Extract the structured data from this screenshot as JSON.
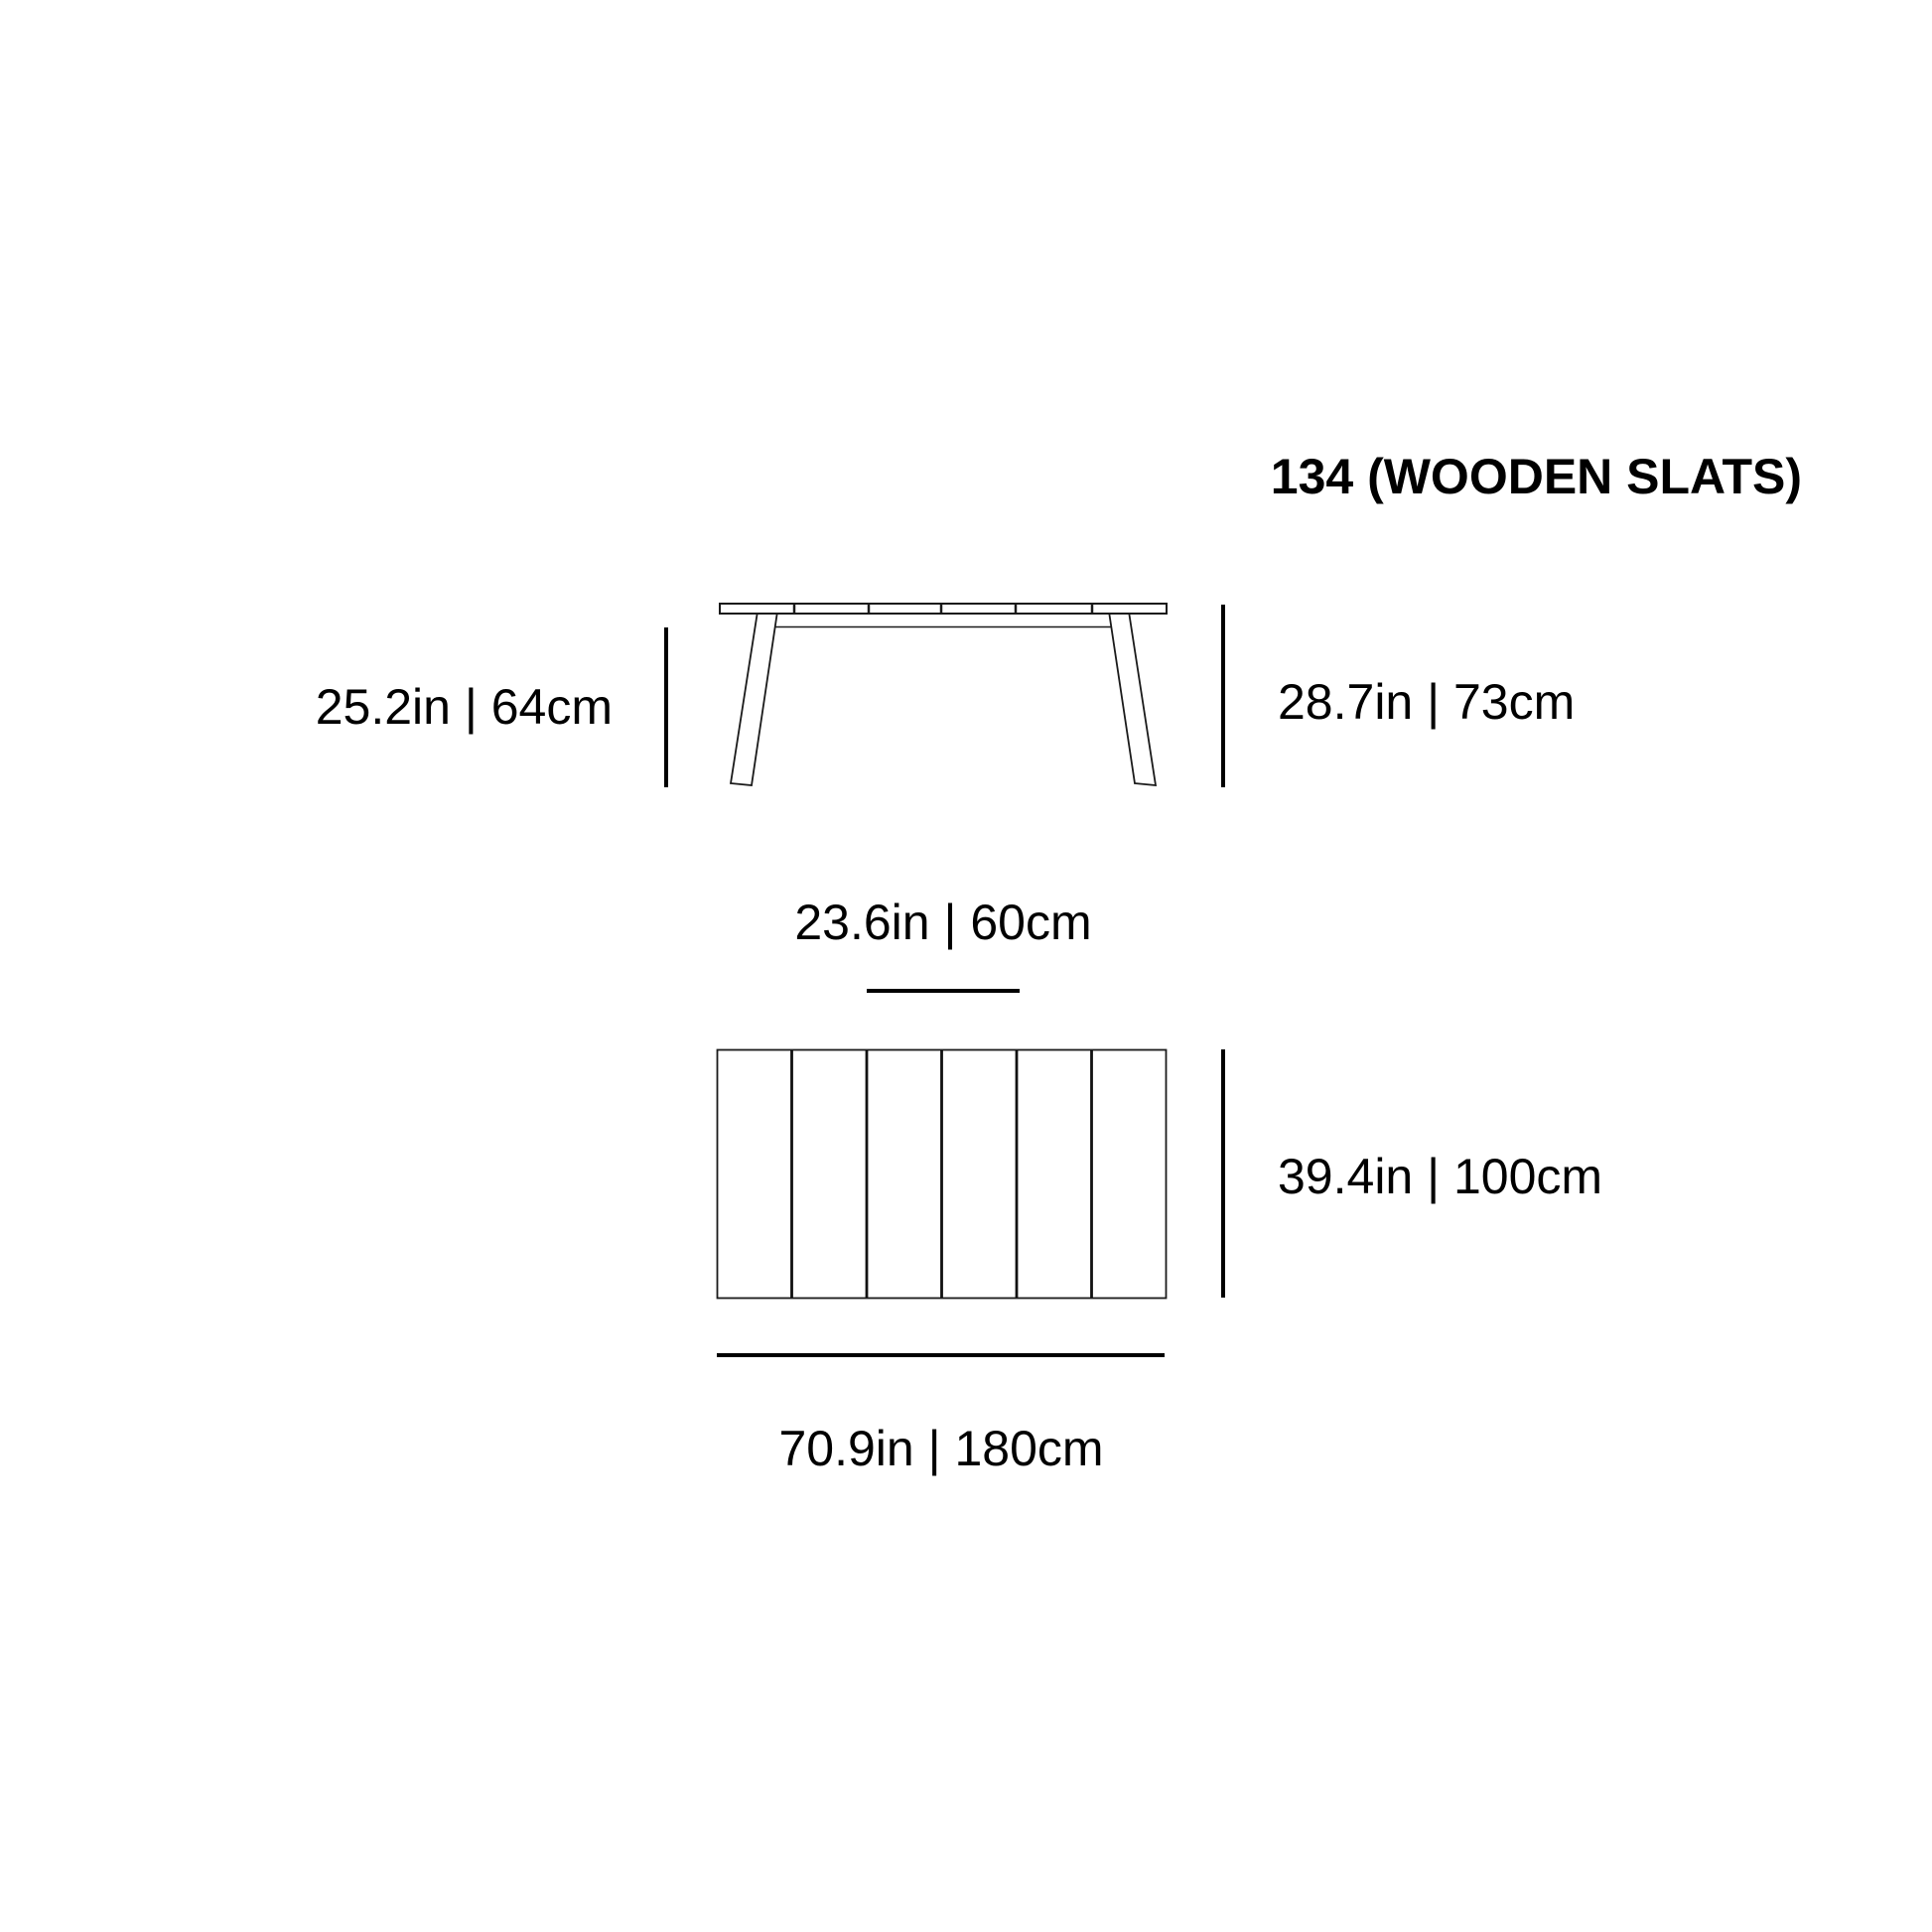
{
  "page": {
    "background_color": "#ffffff",
    "line_color": "#000000"
  },
  "title": "134 (WOODEN SLATS)",
  "product": {
    "model_number": "134",
    "material_note": "WOODEN SLATS",
    "slat_count": 6
  },
  "dimensions": {
    "under_top_height": "25.2in | 64cm",
    "total_height": "28.7in | 73cm",
    "slat_section_width": "23.6in | 60cm",
    "top_depth": "39.4in | 100cm",
    "top_width": "70.9in | 180cm"
  }
}
